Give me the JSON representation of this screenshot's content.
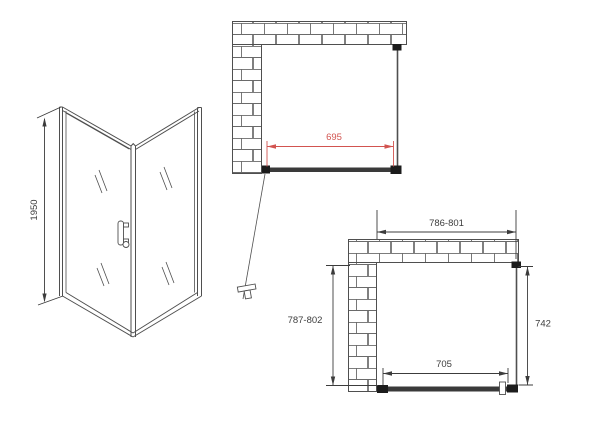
{
  "drawing": {
    "background": "#ffffff",
    "line_color": "#4f4f4f",
    "dim_color": "#3c3c3c",
    "accent_red": "#d25450",
    "brick_line": "#6a6a6a",
    "glass_dark": "#3a3a3a",
    "block_dark": "#1c1c1c",
    "iso_view": {
      "height_label": "1950"
    },
    "top_plan": {
      "door_width_label": "695"
    },
    "bottom_plan": {
      "overall_width_label": "786-801",
      "overall_depth_label": "787-802",
      "side_panel_label": "742",
      "door_width_label": "705"
    }
  }
}
